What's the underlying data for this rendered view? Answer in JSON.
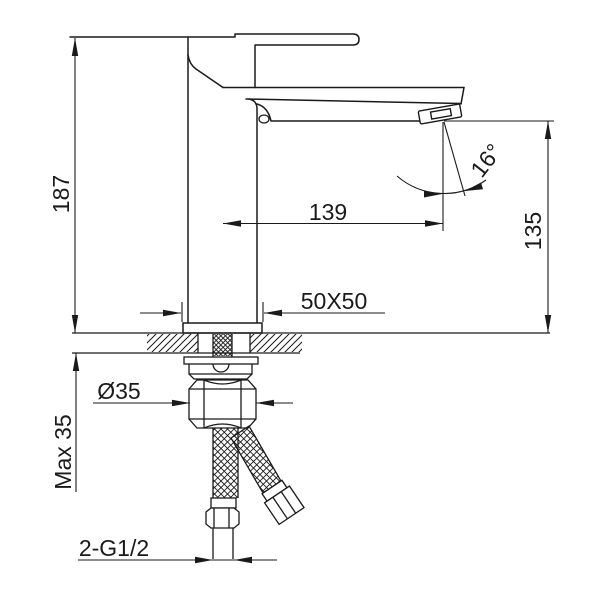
{
  "drawing": {
    "kind": "single-hole basin faucet installation diagram",
    "colors": {
      "background": "#ffffff",
      "line": "#1a1a1a"
    },
    "dims": {
      "overall_height": "187",
      "spout_reach": "139",
      "outlet_height": "135",
      "outlet_angle": "16°",
      "base_footprint": "50X50",
      "mounting_nut_diameter": "Ø35",
      "max_deck_thickness": "Max 35",
      "inlet_connections": "2-G1/2"
    }
  }
}
